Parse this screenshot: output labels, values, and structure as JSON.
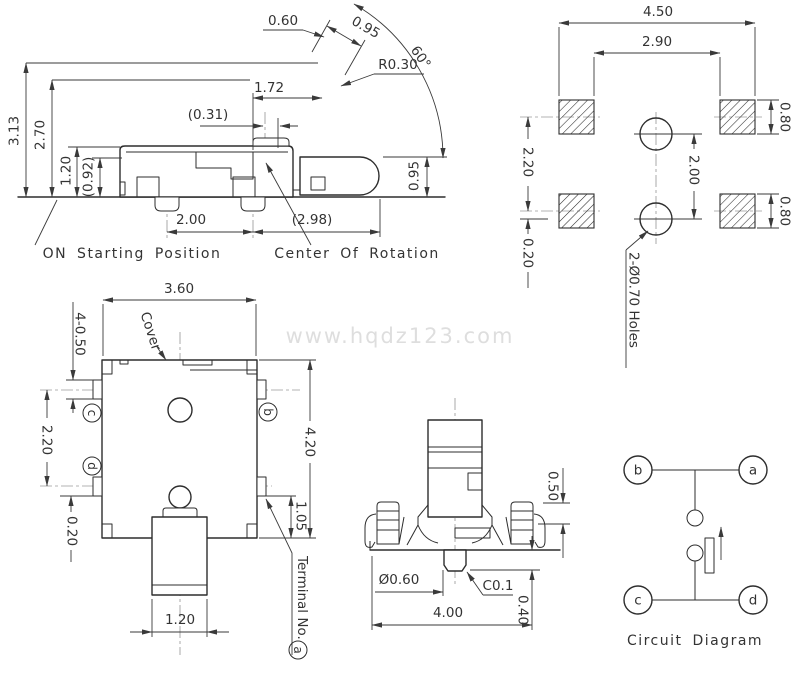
{
  "watermark": {
    "text": "www.hqdz123.com",
    "color": "#dedede"
  },
  "colors": {
    "line": "#2d2d2d",
    "dimension": "#3a3a3a",
    "centerline": "#9a9a9a",
    "background": "#ffffff"
  },
  "side_view": {
    "dims": {
      "d060": "0.60",
      "d095t": "0.95",
      "r030": "R0.30",
      "angle": "60°",
      "d172": "1.72",
      "d031": "(0.31)",
      "d313": "3.13",
      "d270": "2.70",
      "d120": "1.20",
      "d092": "(0.92)",
      "d095r": "0.95",
      "d200": "2.00",
      "d298": "(2.98)"
    },
    "labels": {
      "on_start": "ON Starting Position",
      "center_rot": "Center Of Rotation"
    }
  },
  "pcb_view": {
    "dims": {
      "d450": "4.50",
      "d290": "2.90",
      "d080t": "0.80",
      "d080b": "0.80",
      "d220": "2.20",
      "d200": "2.00",
      "d020": "0.20"
    },
    "labels": {
      "holes": "2-Ø0.70 Holes"
    }
  },
  "top_view": {
    "dims": {
      "d360": "3.60",
      "d4050": "4-0.50",
      "d220": "2.20",
      "d020": "0.20",
      "d420": "4.20",
      "d105": "1.05",
      "d120": "1.20"
    },
    "labels": {
      "cover": "Cover",
      "terminal": "Terminal No.",
      "terminal_ref": "a",
      "pin_b": "b",
      "pin_c": "c",
      "pin_d": "d"
    }
  },
  "front_view": {
    "dims": {
      "d050": "0.50",
      "d060": "Ø0.60",
      "c01": "C0.1",
      "d040": "0.40",
      "d400": "4.00"
    }
  },
  "circuit": {
    "title": "Circuit Diagram",
    "pins": {
      "a": "a",
      "b": "b",
      "c": "c",
      "d": "d"
    }
  }
}
